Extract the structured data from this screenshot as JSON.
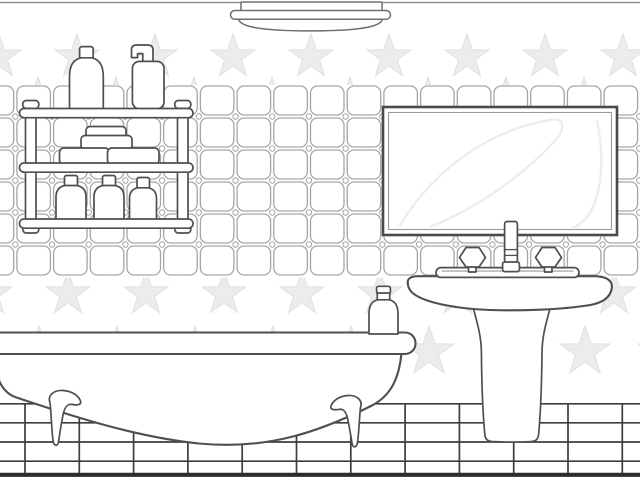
{
  "illustration": {
    "style": "black-and-white coloring-page line art",
    "scene": "bathroom interior",
    "objects": [
      {
        "name": "ceiling-light",
        "label": "flush-mount ceiling lamp"
      },
      {
        "name": "star-wallpaper",
        "label": "light gray star pattern wallpaper"
      },
      {
        "name": "tile-wall",
        "label": "rounded square wall tile band"
      },
      {
        "name": "wall-shelf",
        "label": "two-post wall shelf with toiletries"
      },
      {
        "name": "shampoo-bottle",
        "label": "shampoo bottle on top shelf"
      },
      {
        "name": "pump-bottle",
        "label": "soap dispenser pump bottle on top shelf"
      },
      {
        "name": "soap-stack",
        "label": "four stacked soap bars on middle shelf"
      },
      {
        "name": "shelf-bottles",
        "label": "three small lotion bottles on bottom shelf"
      },
      {
        "name": "wall-mirror",
        "label": "rectangular framed wall mirror with reflection highlights"
      },
      {
        "name": "pedestal-sink",
        "label": "pedestal sink basin"
      },
      {
        "name": "faucet",
        "label": "center spout with two crystal knob handles"
      },
      {
        "name": "bathtub",
        "label": "clawfoot bathtub with rolled rim"
      },
      {
        "name": "rim-bottle",
        "label": "small bottle standing on bathtub rim"
      },
      {
        "name": "floor-tiles",
        "label": "rectangular grid tiled floor"
      }
    ]
  },
  "colors": {
    "background": "#ffffff",
    "ink": "#4f4f4f",
    "ink_soft": "#6e6e6e",
    "tile_line": "#a6a6a6",
    "star_fill": "#ececec",
    "star_stroke": "#e0e0e0",
    "floor_line": "#3d3d3d",
    "floor_base": "#2c2c2c",
    "ceiling_line": "#8f8f8f",
    "reflection": "#ededed"
  },
  "stars": {
    "spacing": 78,
    "rows": [
      {
        "y": 57,
        "offset": 77,
        "r": 23,
        "zone": "upper"
      },
      {
        "y": 100,
        "offset": 38,
        "r": 23,
        "zone": "upper"
      },
      {
        "y": 294,
        "offset": -10,
        "r": 23,
        "zone": "lower"
      },
      {
        "y": 352,
        "offset": 39,
        "r": 26,
        "zone": "lower"
      }
    ]
  },
  "tiles": {
    "band": {
      "x": 0,
      "y": 85,
      "w": 640,
      "h": 192
    },
    "start_x": -19.8,
    "start_y": 86,
    "pitch_x": 36.7,
    "pitch_y": 32,
    "tile_w": 33.5,
    "tile_h": 29,
    "radius": 7,
    "cols": 19,
    "rows": 6,
    "dot_r": 2.7
  },
  "floor": {
    "area": {
      "x": 0,
      "y": 403,
      "w": 640,
      "h": 77
    },
    "h_lines": [
      403.8,
      422.8,
      442,
      461.2
    ],
    "v_start": 25,
    "v_pitch": 54.3,
    "v_count": 12,
    "v_top": 403.8,
    "v_bottom": 473.5,
    "base_y": 474.8
  }
}
